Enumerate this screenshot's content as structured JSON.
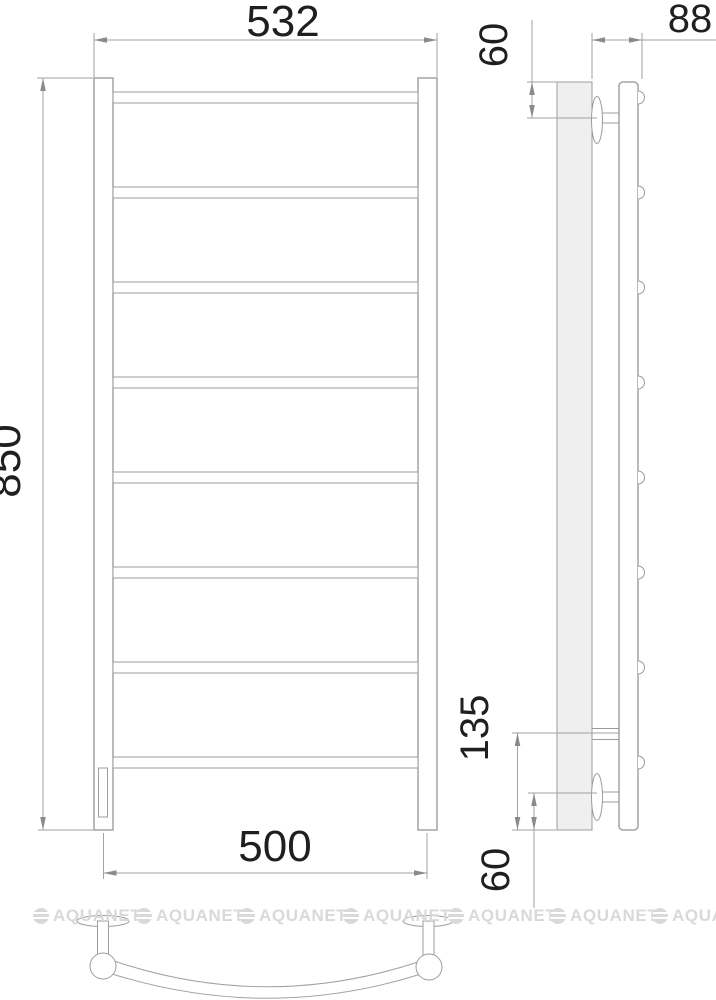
{
  "drawing": {
    "front_view": {
      "top_width": "532",
      "height": "850",
      "bottom_width": "500",
      "rung_count": 8
    },
    "side_view": {
      "depth": "88",
      "top_bracket_offset": "60",
      "bottom_pipe_offset": "135",
      "bottom_bracket_offset": "60"
    }
  },
  "watermark": {
    "text": "AQUANET"
  },
  "colors": {
    "line": "#949494",
    "dimension_line": "#a2a2a2",
    "dimension_text": "#1f1f1f",
    "plate_fill": "#efefef",
    "watermark": "#d9d9d9",
    "background": "#ffffff"
  }
}
